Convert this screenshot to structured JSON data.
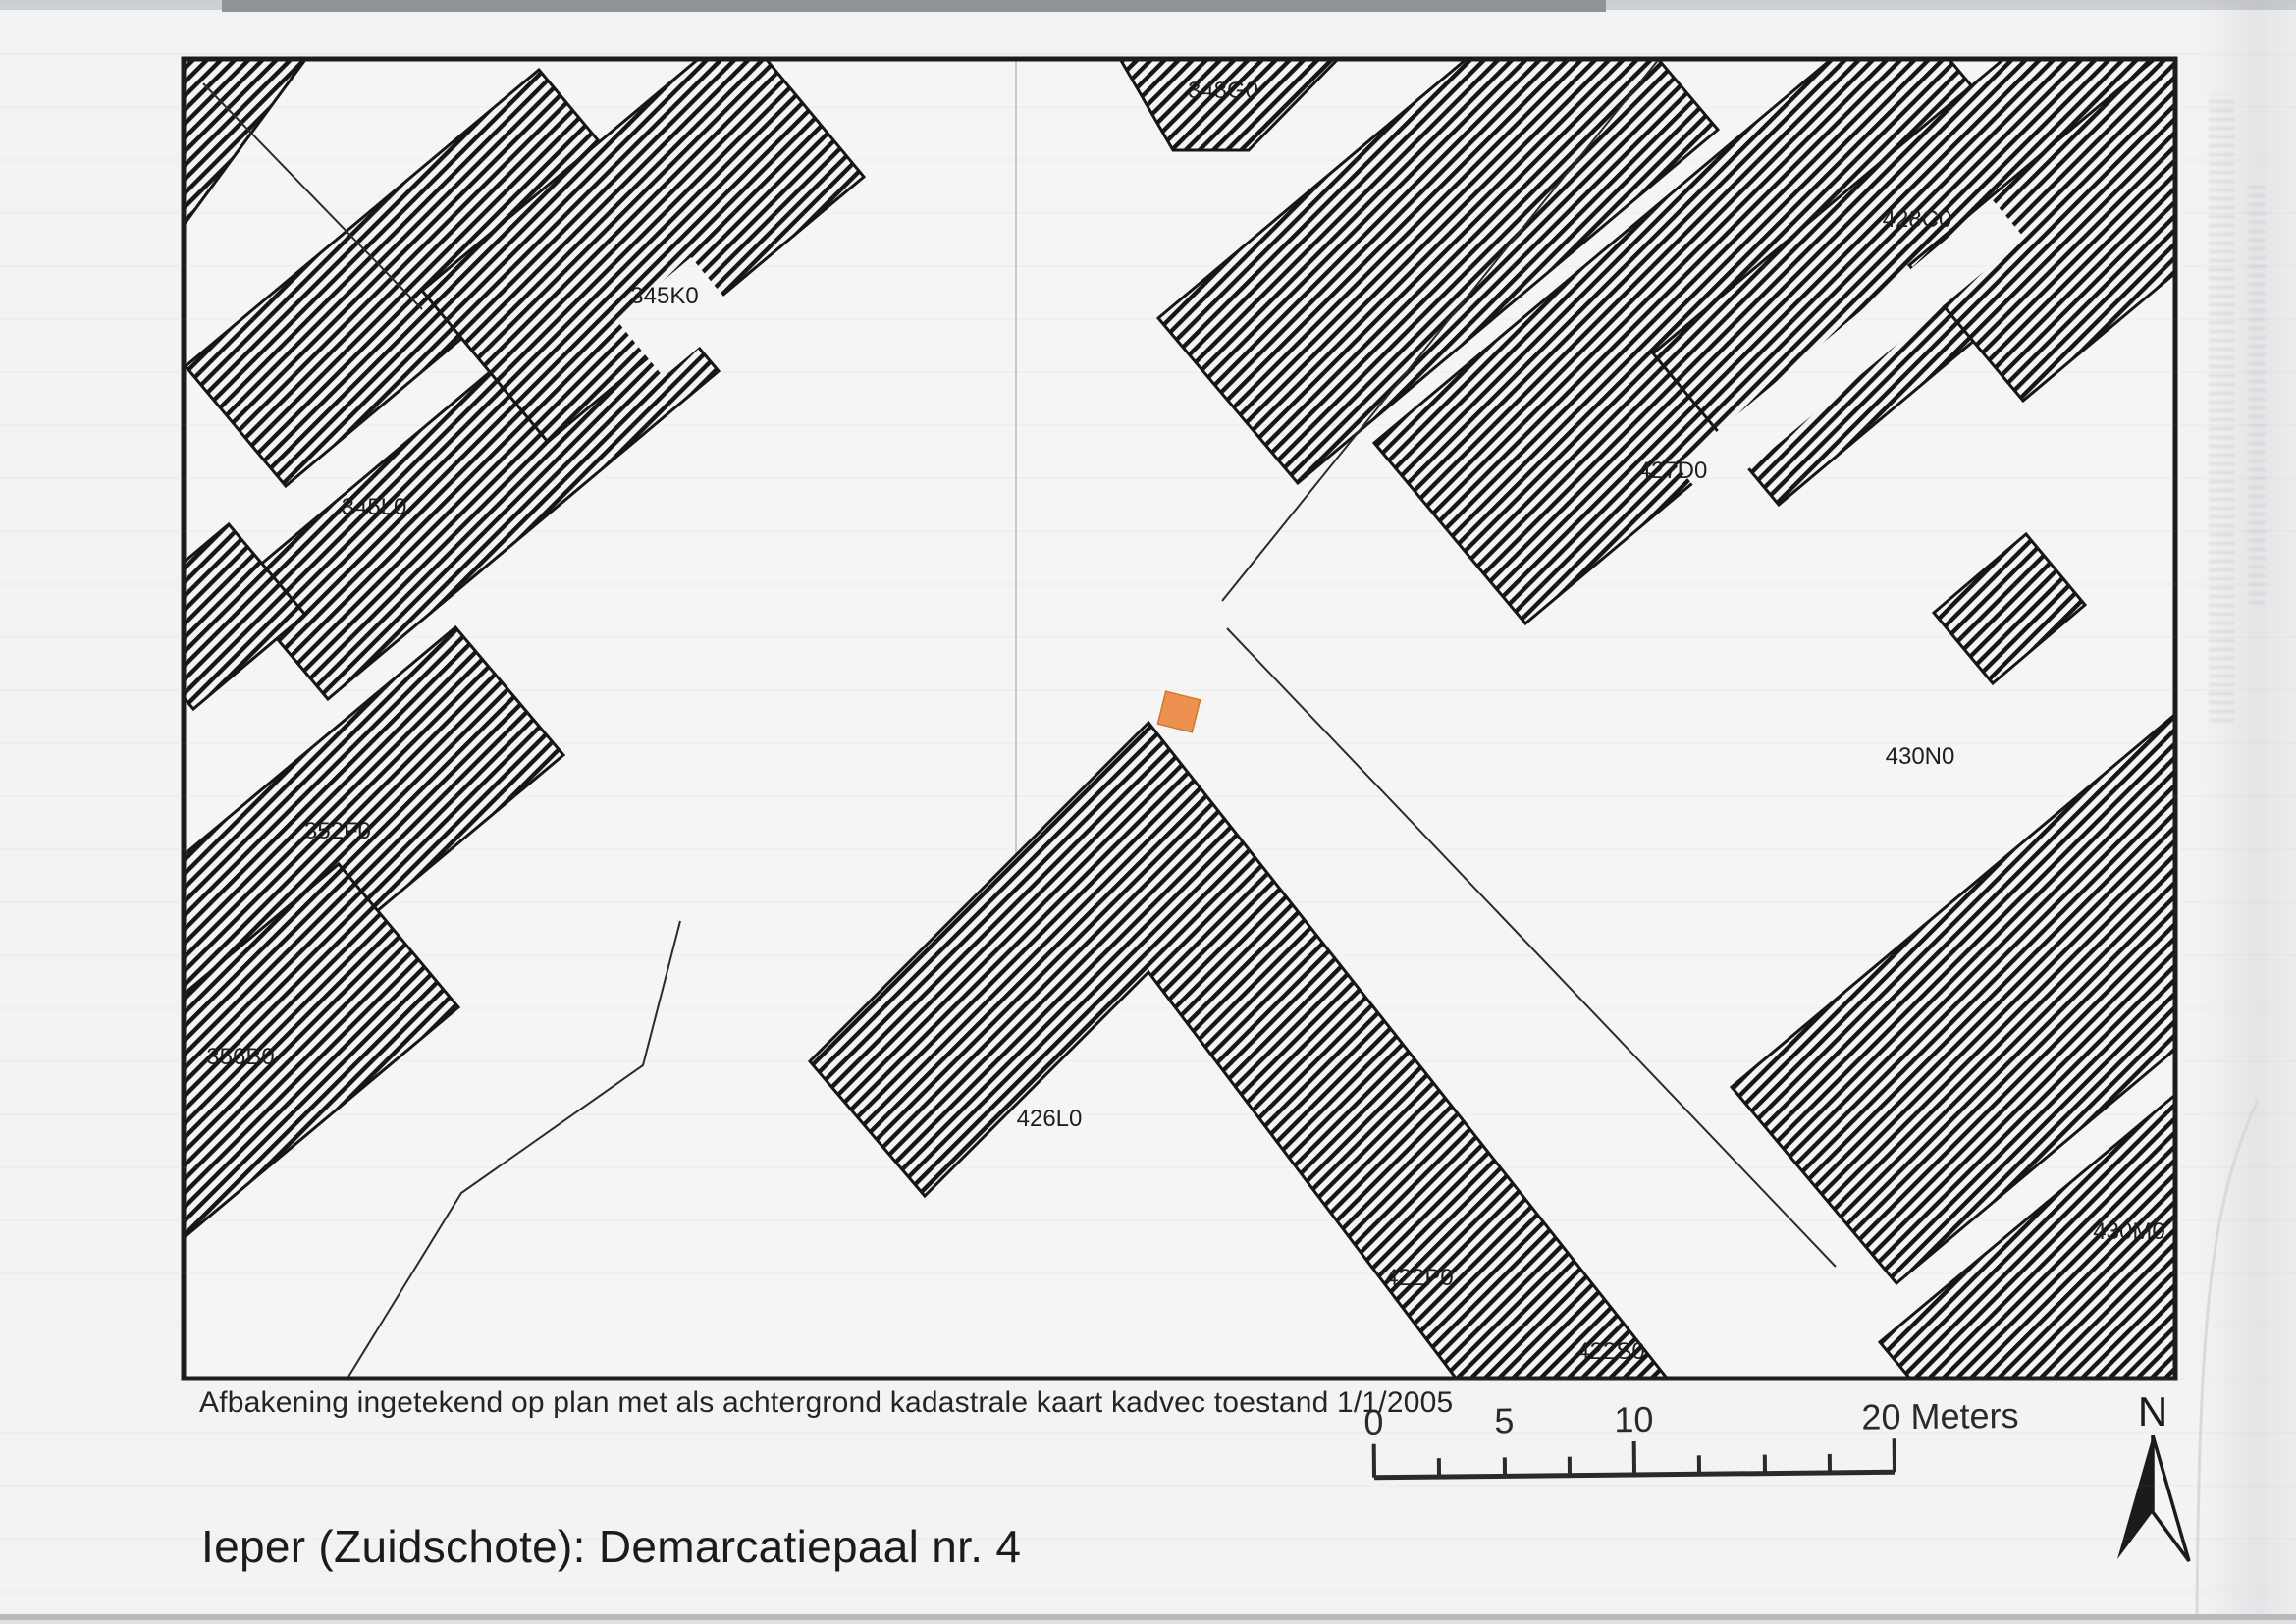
{
  "document": {
    "map_title": "Ieper (Zuidschote): Demarcatiepaal nr. 4",
    "caption": "Afbakening ingetekend op plan met als achtergrond kadastrale kaart kadvec toestand 1/1/2005"
  },
  "map": {
    "parcel_labels": [
      {
        "id": "357D0"
      },
      {
        "id": "345K0"
      },
      {
        "id": "345L0"
      },
      {
        "id": "352F0"
      },
      {
        "id": "356B0"
      },
      {
        "id": "348G0"
      },
      {
        "id": "428C0"
      },
      {
        "id": "427D0"
      },
      {
        "id": "430N0"
      },
      {
        "id": "426L0"
      },
      {
        "id": "422P0"
      },
      {
        "id": "422S0"
      },
      {
        "id": "430M0"
      }
    ],
    "marker": {
      "name": "demarcatiepaal-locatie",
      "color": "#ec9150"
    }
  },
  "scale_bar": {
    "labels": [
      "0",
      "5",
      "10",
      "20 Meters"
    ]
  },
  "north_arrow": {
    "label": "N"
  },
  "colors": {
    "paper": "#f3f3f4",
    "hatch_ink": "#161616",
    "frame_ink": "#1c1c1c",
    "marker_orange": "#ec9150"
  }
}
